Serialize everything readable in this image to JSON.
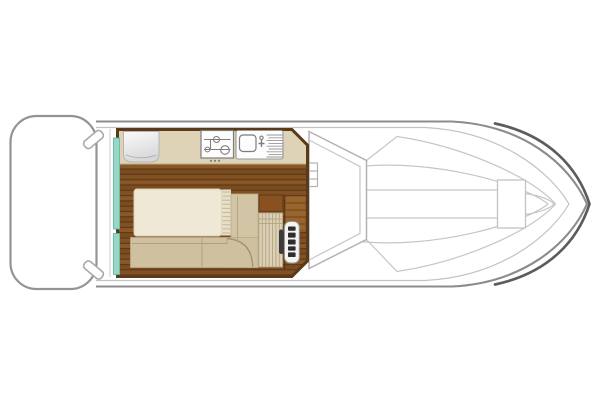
{
  "canvas": {
    "width": 600,
    "height": 400,
    "background": "#ffffff"
  },
  "diagram": {
    "kind": "boat-deck-floorplan",
    "orientation": "bow-right",
    "legend": {
      "swim_platform": "stern swim platform",
      "mooring_cleat": "mooring cleat",
      "hull": "hull outline",
      "saloon": "saloon cabin with wood floor",
      "sliding_door": "port-side sliding door (teal)",
      "fridge": "fridge / galley cabinet",
      "stove": "two-burner hob",
      "sink": "sink with drainboard",
      "double_bed": "double bed",
      "bed_slats": "bed fold slats",
      "l_sofa": "L-shaped sofa bench",
      "dinette_table": "dinette table",
      "helm_seat": "striped helm seat",
      "companionway_steps": "companionway steps",
      "helm_console": "helm console with instruments",
      "steering_wheel": "steering wheel",
      "cockpit_step": "cockpit side step",
      "windshield": "windshield / cockpit coaming",
      "foredeck_walkway": "foredeck centre walkway",
      "bow_locker": "foredeck locker hatch"
    }
  },
  "colors": {
    "hull_outline": "#8c8c8c",
    "hull_inner": "#c3c3c3",
    "bow_edge": "#5c5c5c",
    "platform_outline": "#949494",
    "cleat": "#a9a9a9",
    "deck_line": "#d2d2d2",
    "windshield_line": "#b2b2b2",
    "detail_line": "#c6c6c6",
    "cabin_border": "#593a1b",
    "wood_plank_a": "#815023",
    "wood_plank_b": "#8a5827",
    "wood_plank_c": "#7a4c20",
    "wood_seam": "#5b3715",
    "counter": "#ded3b6",
    "counter_seam": "#bfae84",
    "appliance_white": "#fdfdfd",
    "appliance_line": "#7d7d7d",
    "fridge_light": "#fbfbfb",
    "fridge_dark": "#d8d8da",
    "fridge_edge": "#b5b5b5",
    "door_teal": "#96d7c6",
    "door_teal_edge": "#63b4a2",
    "bed": "#efe8d6",
    "bed_edge": "#dbcfb5",
    "bed_slat_band": "#e7dfc8",
    "bed_slat_line": "#c6b897",
    "sofa": "#cfc1a0",
    "sofa_alt": "#d2c5a6",
    "sofa_edge": "#b9ab87",
    "sofa_seam": "#b0a17e",
    "sofa_arc": "#a3946f",
    "seat_stripe_bg": "#dbd1b6",
    "seat_stripe_line": "#b6a885",
    "table": "#8a5120",
    "table_edge": "#63401b",
    "steps": "#9a642e",
    "steps_line": "#6b431d",
    "console": "#f3f3f1",
    "console_edge": "#989898",
    "console_button": "#2e2e30",
    "wheel": "#3b3b3d",
    "white": "#ffffff"
  }
}
